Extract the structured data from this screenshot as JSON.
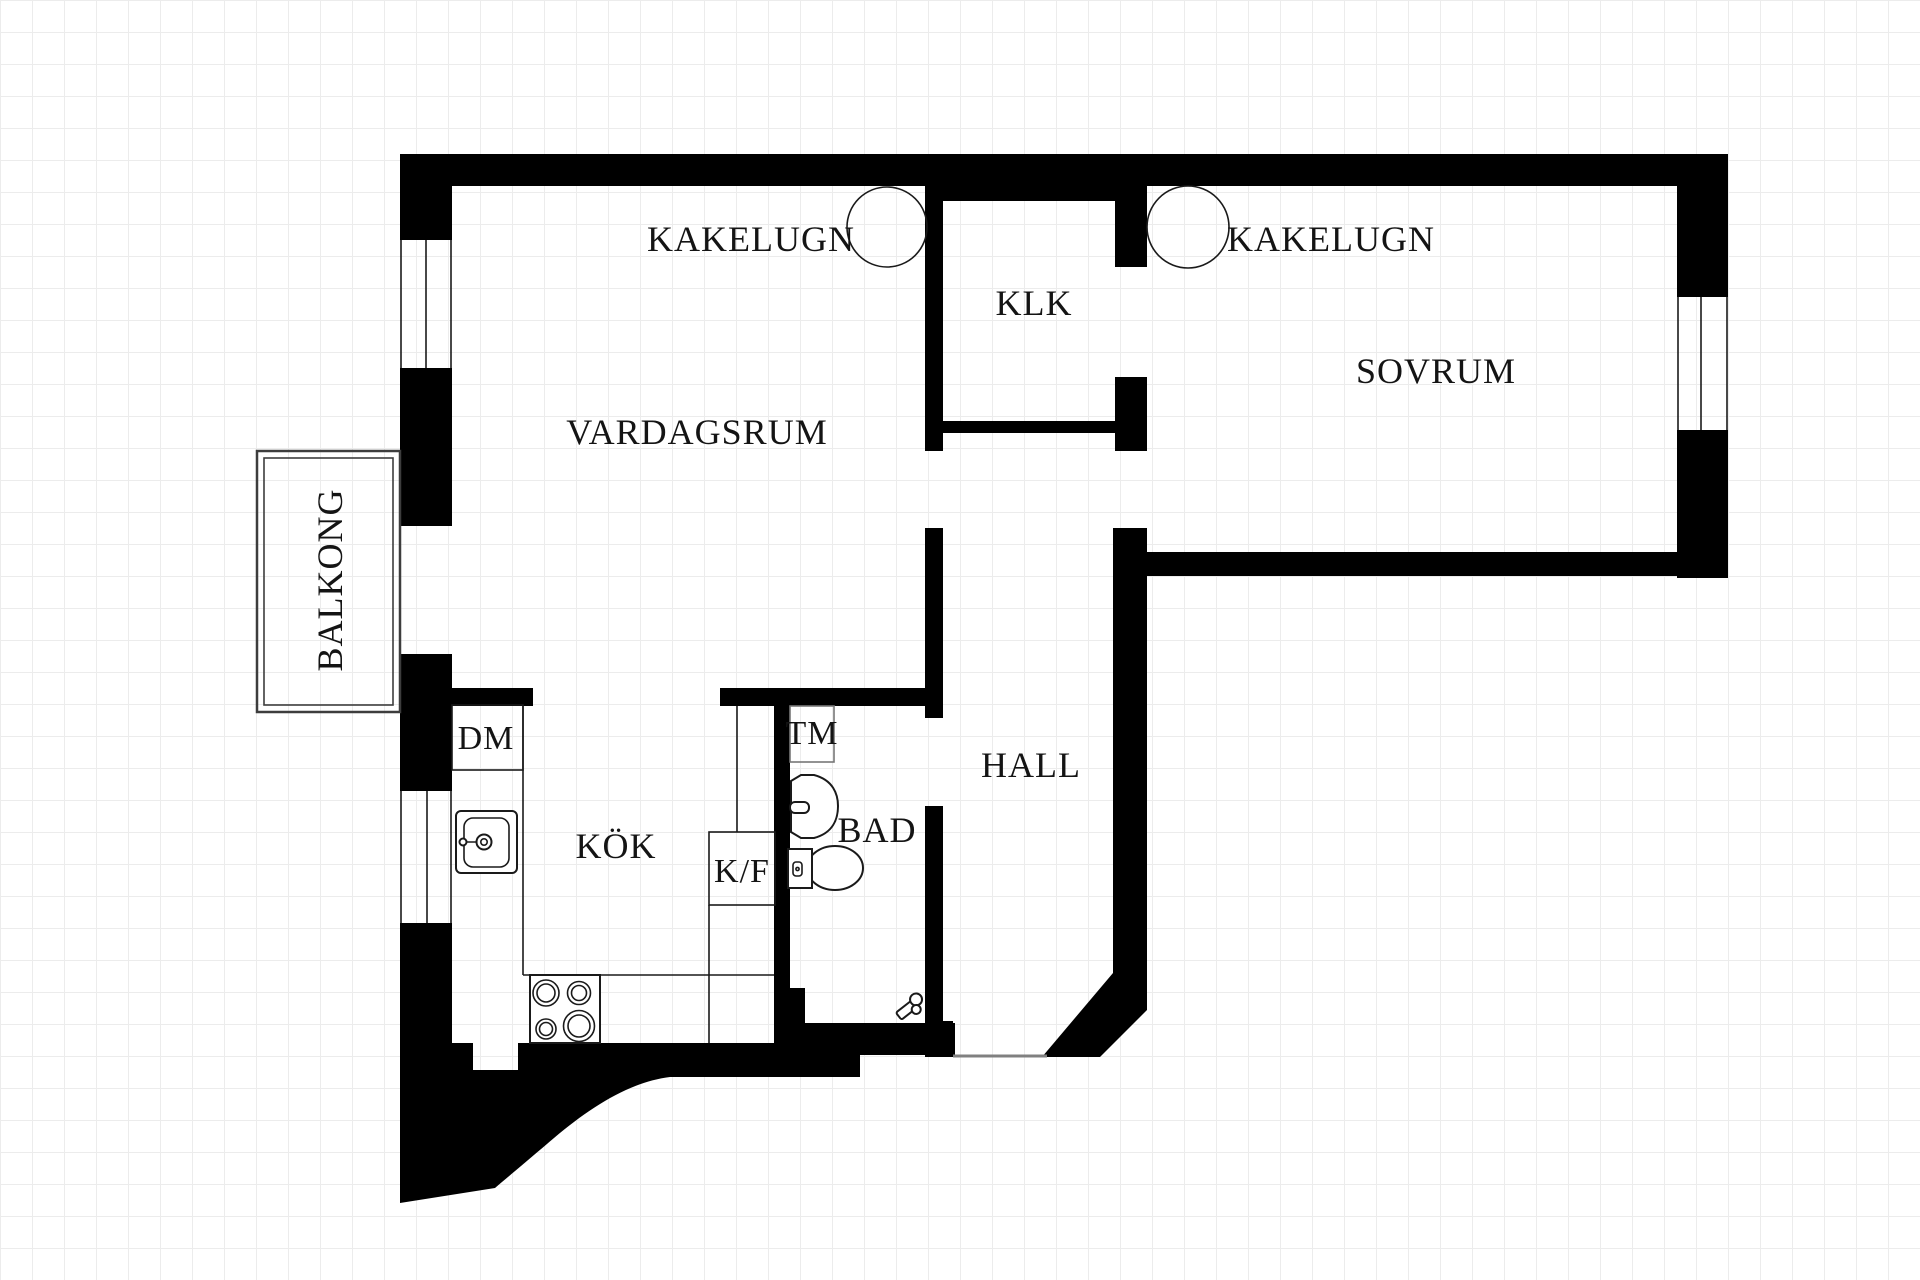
{
  "drawing": {
    "kind": "apartment floor plan",
    "grid_size_px": 32,
    "canvas": {
      "width": 1920,
      "height": 1280
    }
  },
  "colors": {
    "wall": "#000000",
    "background": "#ffffff",
    "grid": "#ececec",
    "text": "#141414"
  },
  "rooms": {
    "vardagsrum": {
      "label": "VARDAGSRUM"
    },
    "sovrum": {
      "label": "SOVRUM"
    },
    "klk": {
      "label": "KLK"
    },
    "kok": {
      "label": "KÖK"
    },
    "bad": {
      "label": "BAD"
    },
    "hall": {
      "label": "HALL"
    },
    "balkong": {
      "label": "BALKONG"
    }
  },
  "features": {
    "kakelugn_left": {
      "label": "KAKELUGN"
    },
    "kakelugn_right": {
      "label": "KAKELUGN"
    }
  },
  "appliances": {
    "dm": {
      "label": "DM"
    },
    "tm": {
      "label": "TM"
    },
    "kf": {
      "label": "K/F"
    }
  }
}
